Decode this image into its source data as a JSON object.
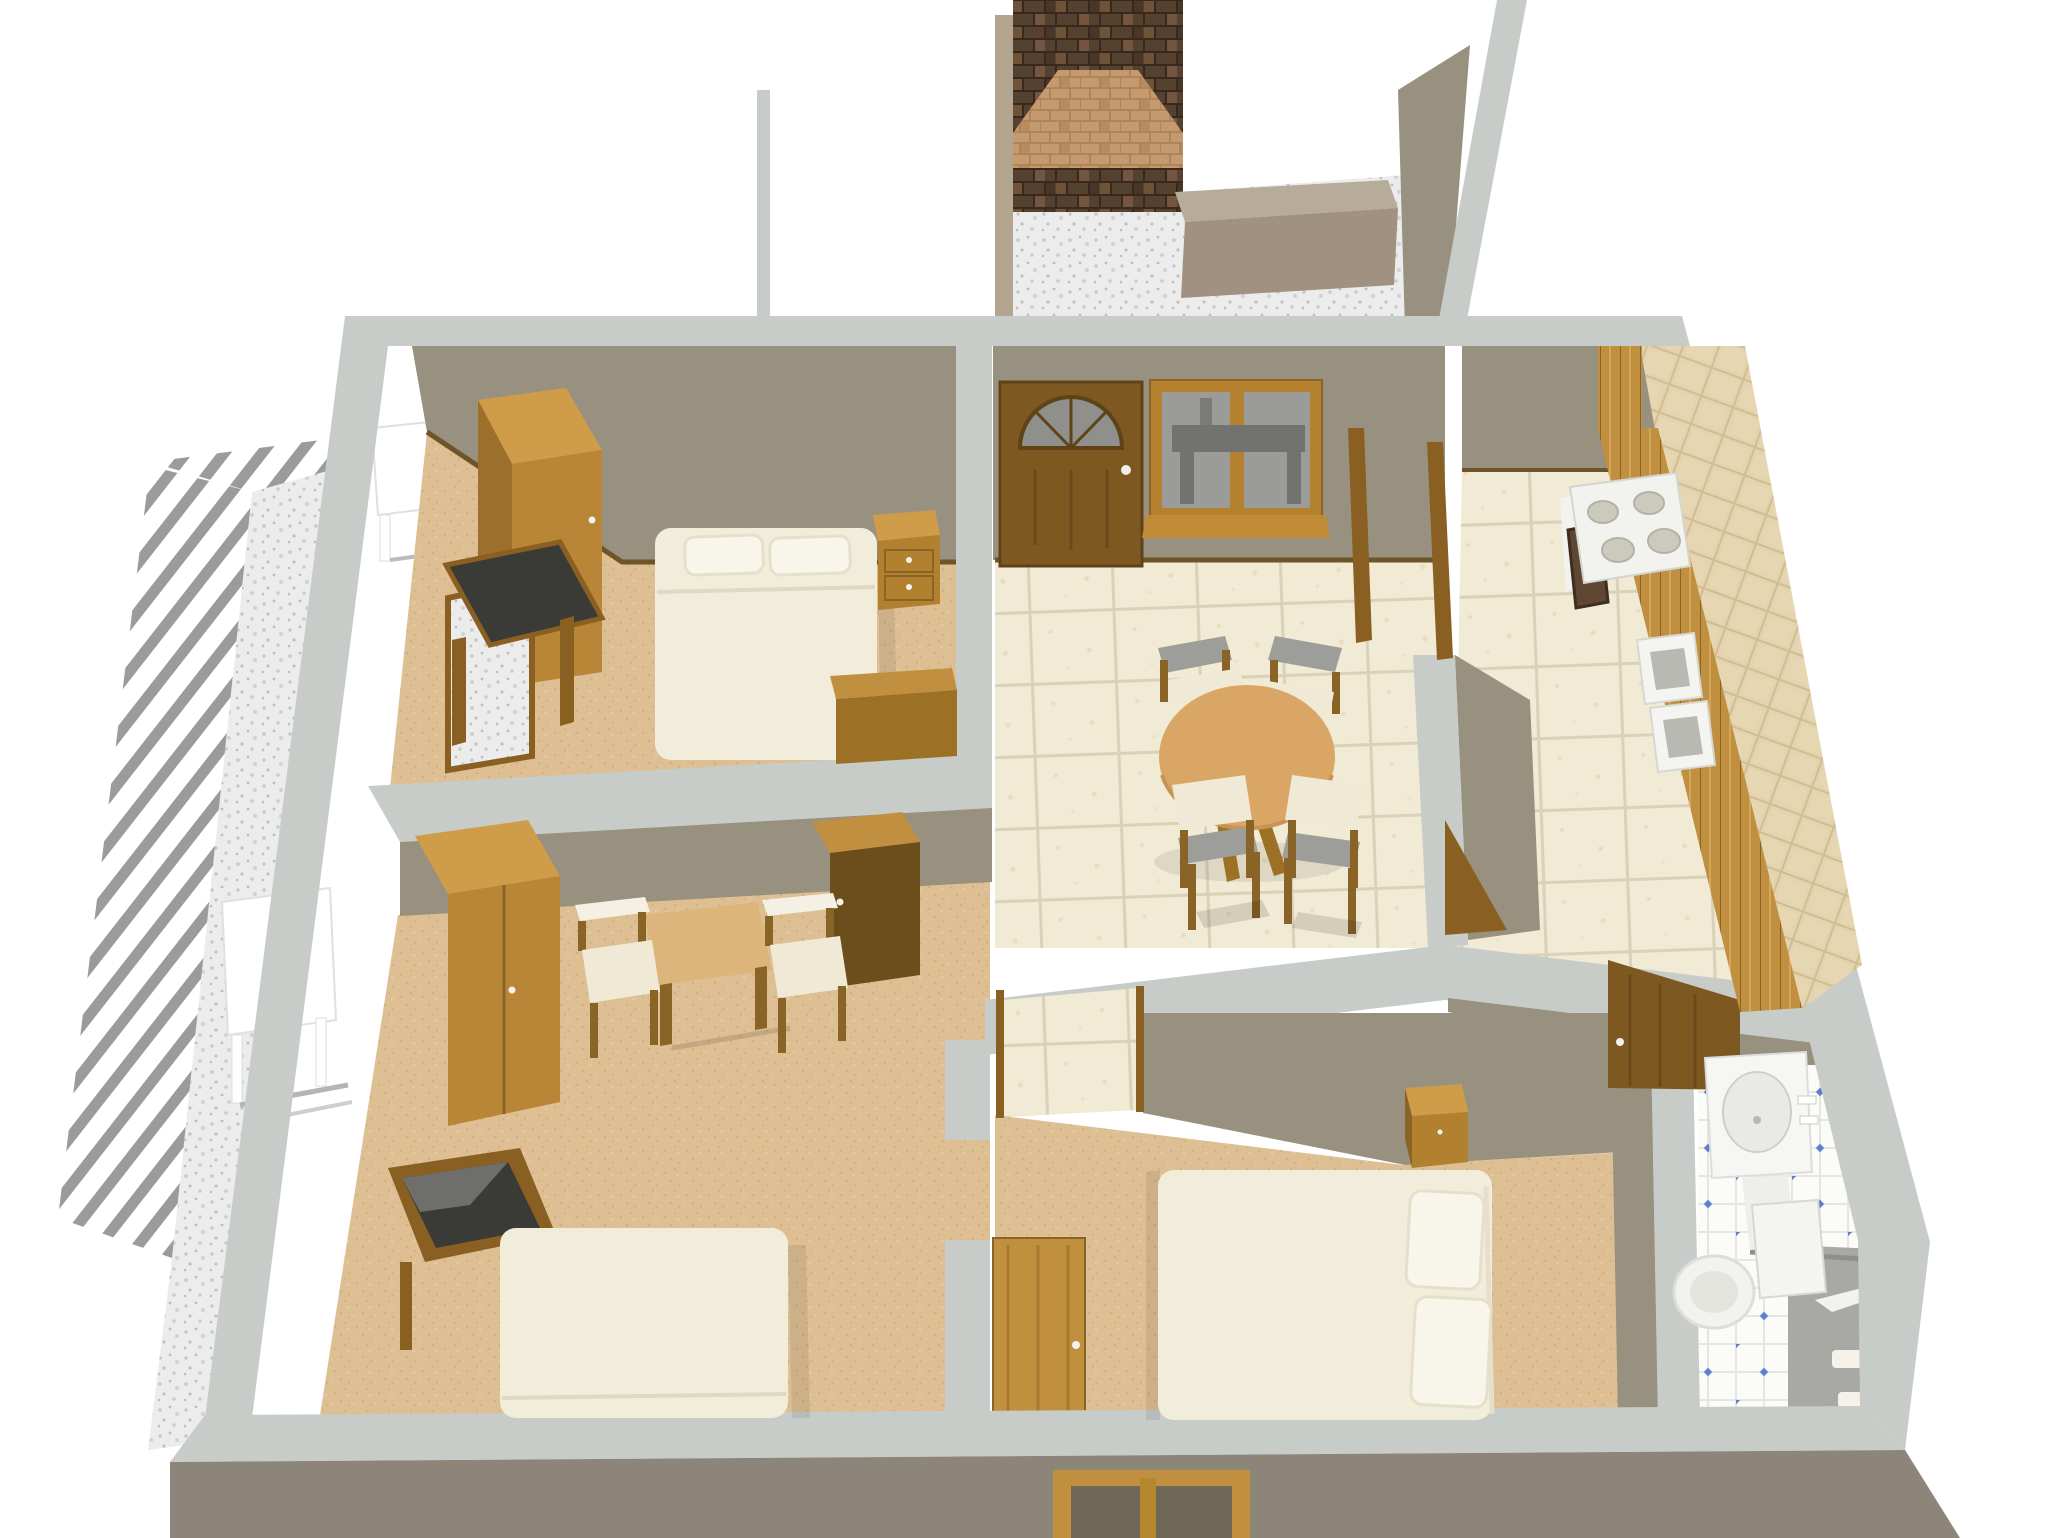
{
  "scene": {
    "description": "3D rendered bird's-eye floor plan of an apartment with three bedrooms, dining room, kitchen, bathroom, outdoor terrace and brick chimney patio",
    "background": "#ffffff"
  },
  "colors": {
    "background": "#ffffff",
    "wall_top": "#c8ccc8",
    "wall_face": "#99917f",
    "wall_face_dark": "#8d8579",
    "baseline_wood": "#6e5429",
    "carpet": "#debf93",
    "carpet_dot": "#d0ae7c",
    "tile": "#f1ead4",
    "tile_grout": "#d9d1b8",
    "bath_tile": "#fbfbf9",
    "bath_grout": "#e6e6e1",
    "bath_dot": "#5b7fd0",
    "bath_gray_floor": "#a8a8a4",
    "gravel": "#ececec",
    "gravel_dot": "#c2c2c2",
    "stripe_gray": "#9b9b9b",
    "brick": "#55412f",
    "brick_mortar": "#38291c",
    "brick_light": "#c59a6f",
    "brick_light_mortar": "#a87f56",
    "wood_light": "#cf9c49",
    "wood_mid": "#b98637",
    "wood_dark": "#8a6426",
    "wood_deep": "#6b4e1c",
    "wood_plank": "#c08f3f",
    "door_brown": "#7d5820",
    "table_top": "#ddb57c",
    "dining_table": "#d9a665",
    "bed": "#f2ecdb",
    "bed_fold": "#e0d8c2",
    "pillow": "#f8f5ea",
    "pillow_edge": "#e6dfcc",
    "chair_seat": "#efe9d6",
    "chair_back": "#9d9d99",
    "glass": "#9b9b98",
    "glass_dark": "#727270",
    "mirror": "#3a3a36",
    "mirror_frame": "#8a5f22",
    "white_fixture": "#f6f6f3",
    "fixture_shade": "#e9e9e5",
    "fixture_line": "#d8d8d3",
    "counter": "#e3d3ae",
    "counter_grid": "#d0bd92",
    "stove_burner": "#ccc9bd",
    "stove_burner_edge": "#b4b1a6",
    "oven_dark": "#5e4632",
    "planter_top": "#b7ab99",
    "planter_front": "#a09180",
    "patio_wall_tan": "#b3a58f",
    "garden_white": "#ffffff",
    "shadow": "rgba(0,0,0,0.12)",
    "shadow_soft": "rgba(0,0,0,0.08)"
  },
  "rooms": [
    {
      "id": "bedroom-top-left",
      "furniture": [
        "wardrobe",
        "dressing-mirror",
        "west-window",
        "double-bed",
        "two-pillows",
        "nightstand",
        "low-chest"
      ]
    },
    {
      "id": "bedroom-middle-left",
      "furniture": [
        "wardrobe",
        "dark-wardrobe",
        "square-table",
        "two-chairs",
        "dressing-mirror",
        "west-window",
        "double-bed"
      ]
    },
    {
      "id": "bedroom-bottom-center",
      "furniture": [
        "open-door",
        "double-bed",
        "two-pillows",
        "nightstand"
      ]
    },
    {
      "id": "dining-room",
      "furniture": [
        "front-door-with-fan-window",
        "window",
        "round-table",
        "four-chairs",
        "doorway-to-kitchen",
        "open-door"
      ]
    },
    {
      "id": "kitchen",
      "furniture": [
        "stove-four-burners",
        "oven-window",
        "cabinet-row",
        "tiled-counter",
        "double-sink"
      ]
    },
    {
      "id": "bathroom",
      "furniture": [
        "open-door",
        "pedestal-sink",
        "faucet",
        "toilet",
        "shower-rail",
        "gray-shower-floor",
        "soap-items"
      ]
    },
    {
      "id": "terrace",
      "furniture": [
        "pergola-stripe-border",
        "garden-table-small",
        "garden-table-large"
      ]
    },
    {
      "id": "patio",
      "furniture": [
        "brick-chimney",
        "fireplace-opening",
        "planter-bench",
        "stone-floor"
      ]
    }
  ],
  "counts": {
    "dining_chairs": 4,
    "stove_burners": 4,
    "beds": 3,
    "pillows_visible": 4,
    "bedroom_chairs": 2
  }
}
